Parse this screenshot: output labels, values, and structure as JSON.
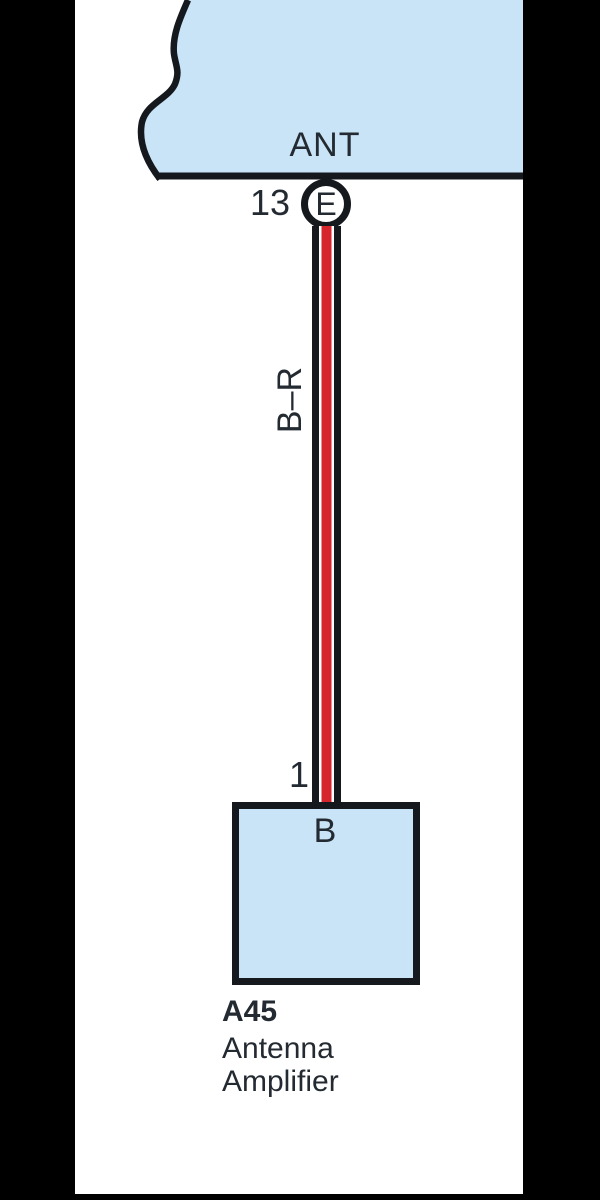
{
  "colors": {
    "block-blue": "#c9e4f7",
    "line-black": "#15181c",
    "wire-red": "#d7252d",
    "text-dark": "#232a31",
    "mask-black": "#000000"
  },
  "diagram": {
    "top_component": {
      "label": "ANT"
    },
    "connector": {
      "pin_number": "13",
      "code": "E"
    },
    "wire": {
      "color_code": "B–R"
    },
    "amplifier": {
      "pin_number": "1",
      "terminal": "B",
      "id": "A45",
      "name": "Antenna Amplifier"
    }
  }
}
